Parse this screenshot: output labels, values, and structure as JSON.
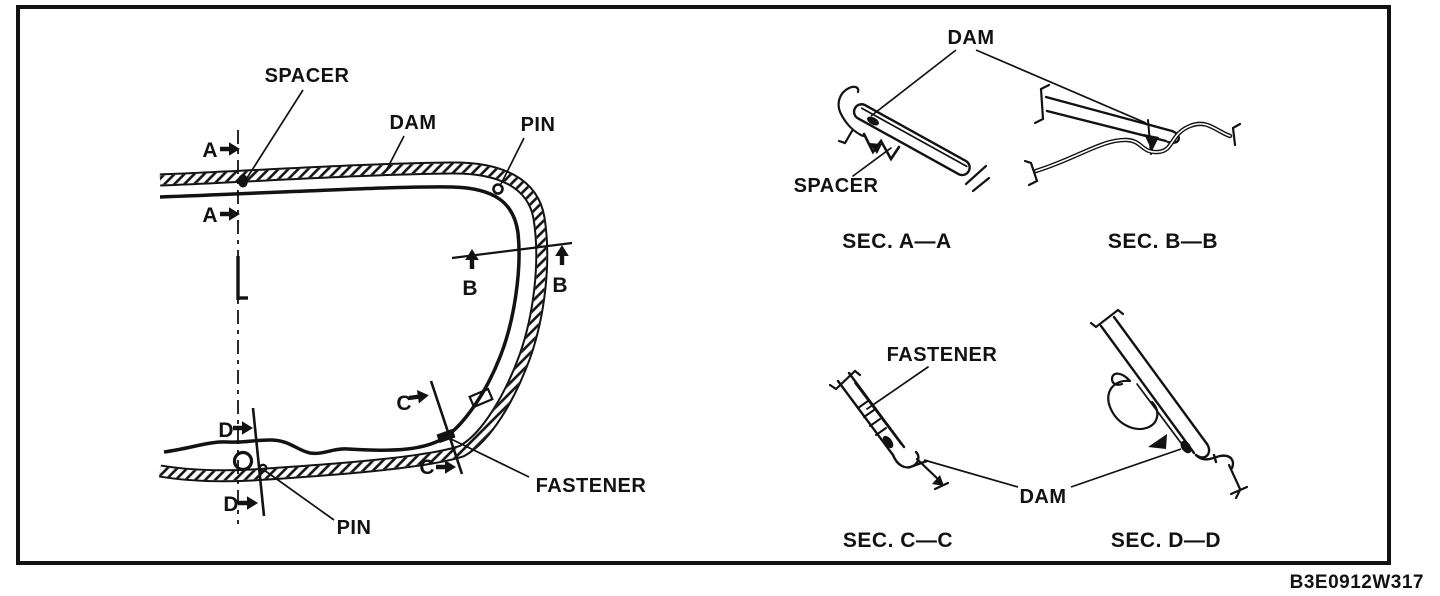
{
  "figure": {
    "code": "B3E0912W317",
    "ink_color": "#121212",
    "paper_color": "#ffffff"
  },
  "main_view": {
    "spacer_label": "SPACER",
    "dam_label": "DAM",
    "pin_top_label": "PIN",
    "pin_bottom_label": "PIN",
    "fastener_label": "FASTENER",
    "marker_a": "A",
    "marker_b": "B",
    "marker_c": "C",
    "marker_d": "D"
  },
  "sections": {
    "dam_top_label": "DAM",
    "spacer_label": "SPACER",
    "fastener_label": "FASTENER",
    "dam_bottom_label": "DAM",
    "caption_aa": "SEC. A—A",
    "caption_bb": "SEC. B—B",
    "caption_cc": "SEC. C—C",
    "caption_dd": "SEC. D—D"
  }
}
